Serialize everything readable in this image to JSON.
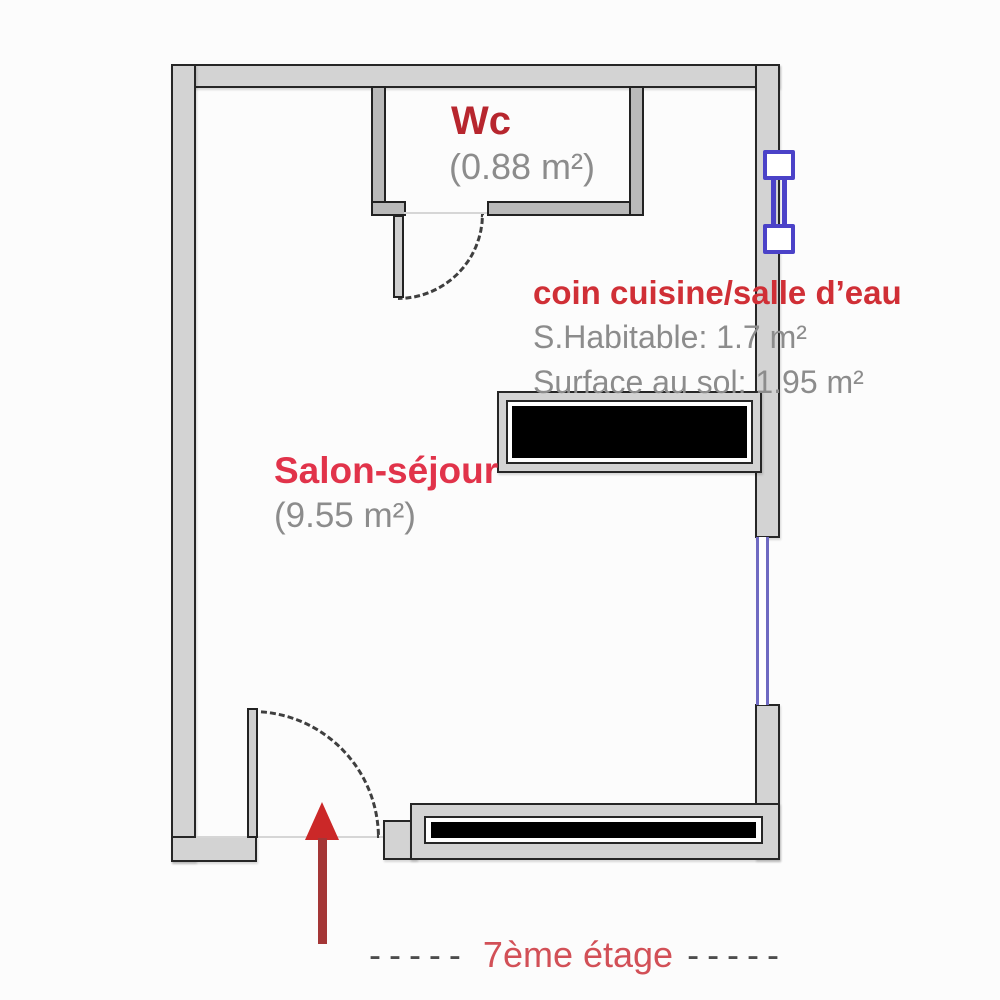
{
  "plan": {
    "type": "apartment-floor-plan",
    "rooms": {
      "wc": {
        "label": "Wc",
        "area": "(0.88 m²)"
      },
      "kitchen": {
        "label": "coin cuisine/salle d’eau",
        "habitable": "S.Habitable: 1.7 m²",
        "floor_area": "Surface au sol: 1.95 m²"
      },
      "salon": {
        "label": "Salon-séjour",
        "area": "(9.55 m²)"
      }
    },
    "caption": {
      "dashes_left": "-----",
      "label": "7ème étage",
      "dashes_right": "-----"
    },
    "icons": {
      "entrance_arrow": "red-up-arrow",
      "small_window": "blue-french-window-symbol",
      "long_window": "blue-double-line-window",
      "door_swing": "dash-dot-quarter-arc"
    },
    "colors": {
      "wall_fill": "#d3d3d3",
      "interior_wall_fill": "#b9b9b9",
      "wall_outline": "#262626",
      "window_blue": "#4b42c8",
      "long_window_blue": "#6f6ac2",
      "wc_label_red": "#b7262e",
      "kitchen_label_red": "#d02f36",
      "salon_label_red": "#e1334a",
      "caption_red": "#d25057",
      "caption_dash_gray": "#4c4c4c",
      "area_text_gray": "#8c8c8c",
      "arrow_red": "#cb2828",
      "counter_black": "#000000"
    }
  }
}
